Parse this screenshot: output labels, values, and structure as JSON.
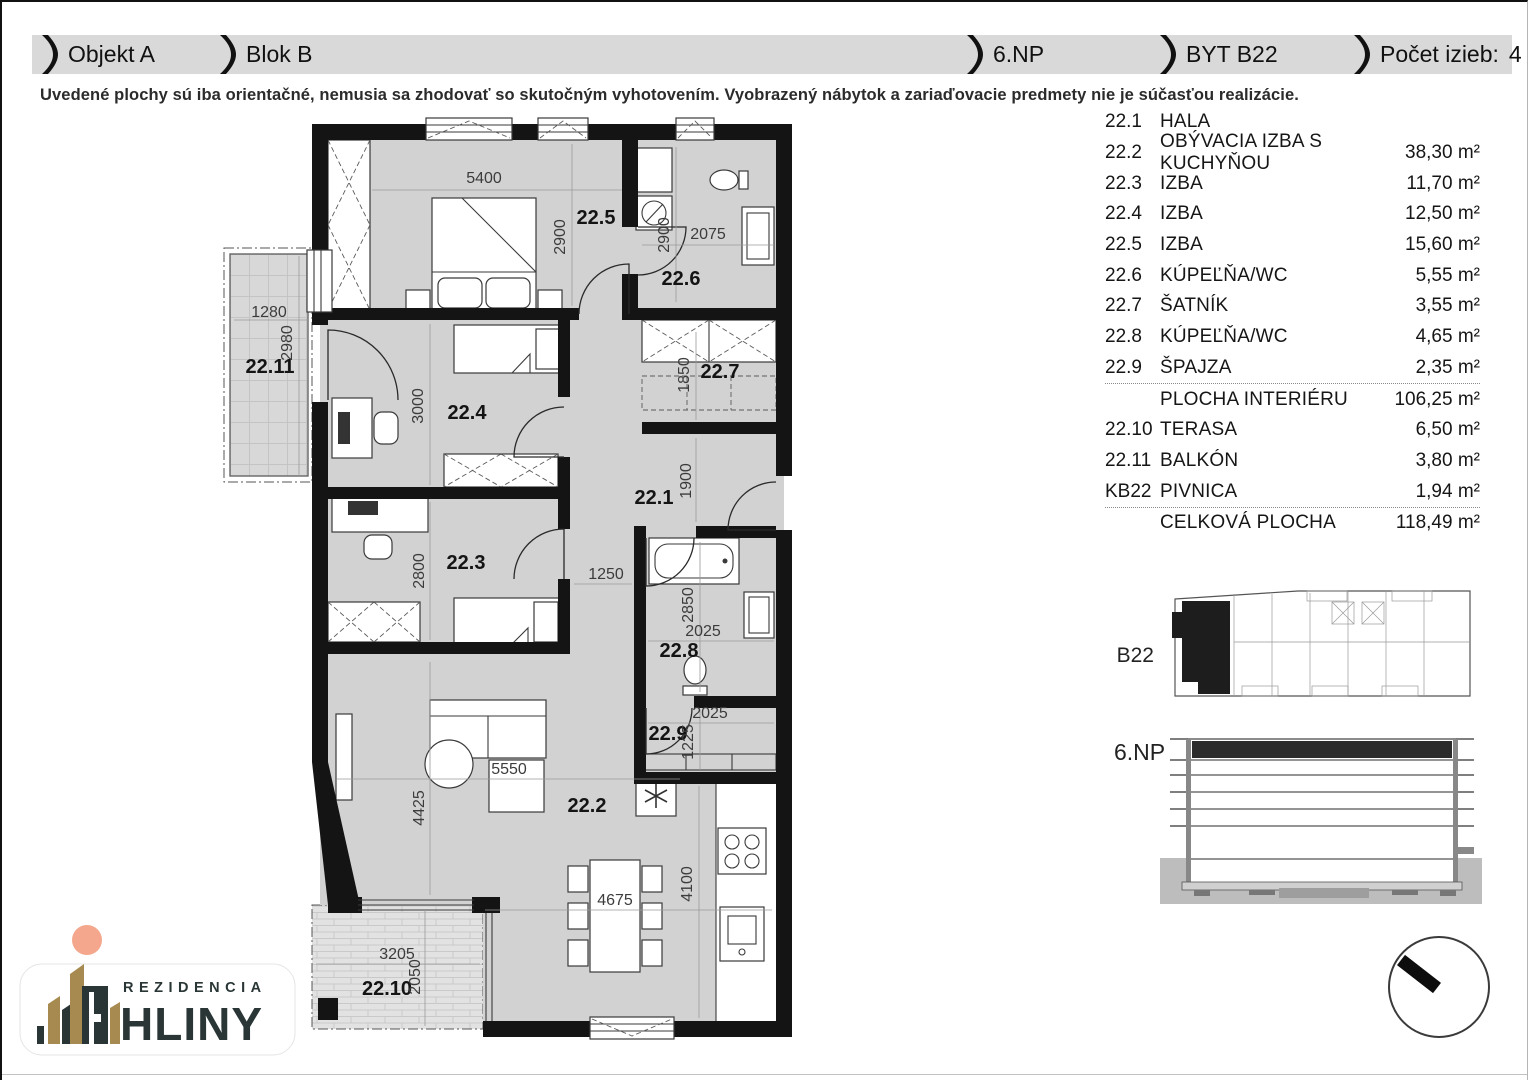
{
  "header": {
    "segments": [
      {
        "label": "Objekt A",
        "value": ""
      },
      {
        "label": "Blok B",
        "value": ""
      },
      {
        "label": "6.NP",
        "value": ""
      },
      {
        "label": "BYT B22",
        "value": ""
      },
      {
        "label": "Počet izieb:",
        "value": "4"
      }
    ]
  },
  "disclaimer": "Uvedené plochy sú iba orientačné, nemusia sa zhodovať so skutočným vyhotovením. Vyobrazený nábytok a zariaďovacie predmety nie je súčasťou realizácie.",
  "room_table": {
    "rows": [
      {
        "code": "22.1",
        "name": "HALA",
        "area": "",
        "summary": false,
        "divider_above": false
      },
      {
        "code": "22.2",
        "name": "OBÝVACIA IZBA S KUCHYŇOU",
        "area": "38,30 m²",
        "summary": false,
        "divider_above": false
      },
      {
        "code": "22.3",
        "name": "IZBA",
        "area": "11,70 m²",
        "summary": false,
        "divider_above": false
      },
      {
        "code": "22.4",
        "name": "IZBA",
        "area": "12,50 m²",
        "summary": false,
        "divider_above": false
      },
      {
        "code": "22.5",
        "name": "IZBA",
        "area": "15,60 m²",
        "summary": false,
        "divider_above": false
      },
      {
        "code": "22.6",
        "name": "KÚPEĽŇA/WC",
        "area": "5,55 m²",
        "summary": false,
        "divider_above": false
      },
      {
        "code": "22.7",
        "name": "ŠATNÍK",
        "area": "3,55 m²",
        "summary": false,
        "divider_above": false
      },
      {
        "code": "22.8",
        "name": "KÚPEĽŇA/WC",
        "area": "4,65 m²",
        "summary": false,
        "divider_above": false
      },
      {
        "code": "22.9",
        "name": "ŠPAJZA",
        "area": "2,35 m²",
        "summary": false,
        "divider_above": false
      },
      {
        "code": "",
        "name": "PLOCHA INTERIÉRU",
        "area": "106,25 m²",
        "summary": true,
        "divider_above": true
      },
      {
        "code": "22.10",
        "name": "TERASA",
        "area": "6,50 m²",
        "summary": false,
        "divider_above": false
      },
      {
        "code": "22.11",
        "name": "BALKÓN",
        "area": "3,80 m²",
        "summary": false,
        "divider_above": false
      },
      {
        "code": "KB22",
        "name": "PIVNICA",
        "area": "1,94 m²",
        "summary": false,
        "divider_above": false
      },
      {
        "code": "",
        "name": "CELKOVÁ PLOCHA",
        "area": "118,49 m²",
        "summary": true,
        "divider_above": true
      }
    ]
  },
  "floorplan": {
    "room_labels": [
      {
        "text": "22.1",
        "x": 652,
        "y": 502
      },
      {
        "text": "22.2",
        "x": 585,
        "y": 810
      },
      {
        "text": "22.3",
        "x": 464,
        "y": 567
      },
      {
        "text": "22.4",
        "x": 465,
        "y": 417
      },
      {
        "text": "22.5",
        "x": 594,
        "y": 222
      },
      {
        "text": "22.6",
        "x": 679,
        "y": 283
      },
      {
        "text": "22.7",
        "x": 718,
        "y": 376
      },
      {
        "text": "22.8",
        "x": 677,
        "y": 655
      },
      {
        "text": "22.9",
        "x": 666,
        "y": 738
      },
      {
        "text": "22.10",
        "x": 385,
        "y": 993
      },
      {
        "text": "22.11",
        "x": 268,
        "y": 371
      }
    ],
    "dim_labels": [
      {
        "text": "5400",
        "x": 482,
        "y": 181,
        "rot": 0
      },
      {
        "text": "2900",
        "x": 563,
        "y": 235,
        "rot": -90
      },
      {
        "text": "2900",
        "x": 667,
        "y": 233,
        "rot": -90
      },
      {
        "text": "2075",
        "x": 706,
        "y": 237,
        "rot": 0
      },
      {
        "text": "1280",
        "x": 267,
        "y": 315,
        "rot": 0
      },
      {
        "text": "2980",
        "x": 290,
        "y": 341,
        "rot": -90
      },
      {
        "text": "3000",
        "x": 421,
        "y": 404,
        "rot": -90
      },
      {
        "text": "1850",
        "x": 687,
        "y": 373,
        "rot": -90
      },
      {
        "text": "1900",
        "x": 689,
        "y": 479,
        "rot": -90
      },
      {
        "text": "2800",
        "x": 422,
        "y": 569,
        "rot": -90
      },
      {
        "text": "1250",
        "x": 604,
        "y": 577,
        "rot": 0
      },
      {
        "text": "2850",
        "x": 691,
        "y": 603,
        "rot": -90
      },
      {
        "text": "2025",
        "x": 701,
        "y": 634,
        "rot": 0
      },
      {
        "text": "2025",
        "x": 708,
        "y": 716,
        "rot": 0
      },
      {
        "text": "1225",
        "x": 691,
        "y": 740,
        "rot": -90
      },
      {
        "text": "5550",
        "x": 507,
        "y": 772,
        "rot": 0
      },
      {
        "text": "4425",
        "x": 422,
        "y": 806,
        "rot": -90
      },
      {
        "text": "4675",
        "x": 613,
        "y": 903,
        "rot": 0
      },
      {
        "text": "4100",
        "x": 690,
        "y": 882,
        "rot": -90
      },
      {
        "text": "3205",
        "x": 395,
        "y": 957,
        "rot": 0
      },
      {
        "text": "2050",
        "x": 418,
        "y": 975,
        "rot": -90
      }
    ]
  },
  "keyplan": {
    "label": "B22"
  },
  "elevation": {
    "label": "6.NP"
  },
  "logo": {
    "line1": "REZIDENCIA",
    "line2": "HLINY"
  },
  "icons": {
    "compass": "north-arrow-icon",
    "logo_mark": "buildings-icon",
    "header_separator": "wing-separator-icon"
  }
}
